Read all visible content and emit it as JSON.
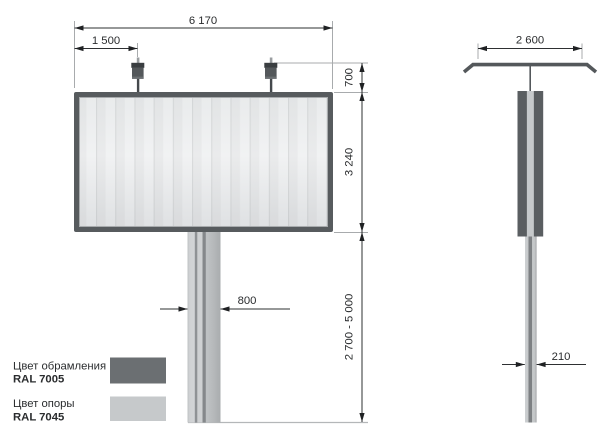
{
  "front_view": {
    "dims": {
      "total_width": "6 170",
      "lamp_offset": "1 500",
      "lamp_height": "700",
      "panel_height": "3 240",
      "support_height_range": "2 700 - 5 000",
      "support_width": "800"
    }
  },
  "side_view": {
    "dims": {
      "lamp_bar_width": "2 600",
      "support_depth": "210"
    }
  },
  "legend": {
    "frame": {
      "label": "Цвет обрамления",
      "code": "RAL 7005",
      "hex": "#6b6f72"
    },
    "support": {
      "label": "Цвет опоры",
      "code": "RAL 7045",
      "hex": "#c6c9cb"
    }
  },
  "colors": {
    "frame_dark": "#575b5e",
    "support_light": "#c3c6c8",
    "dimension_ink": "#2e3032"
  }
}
